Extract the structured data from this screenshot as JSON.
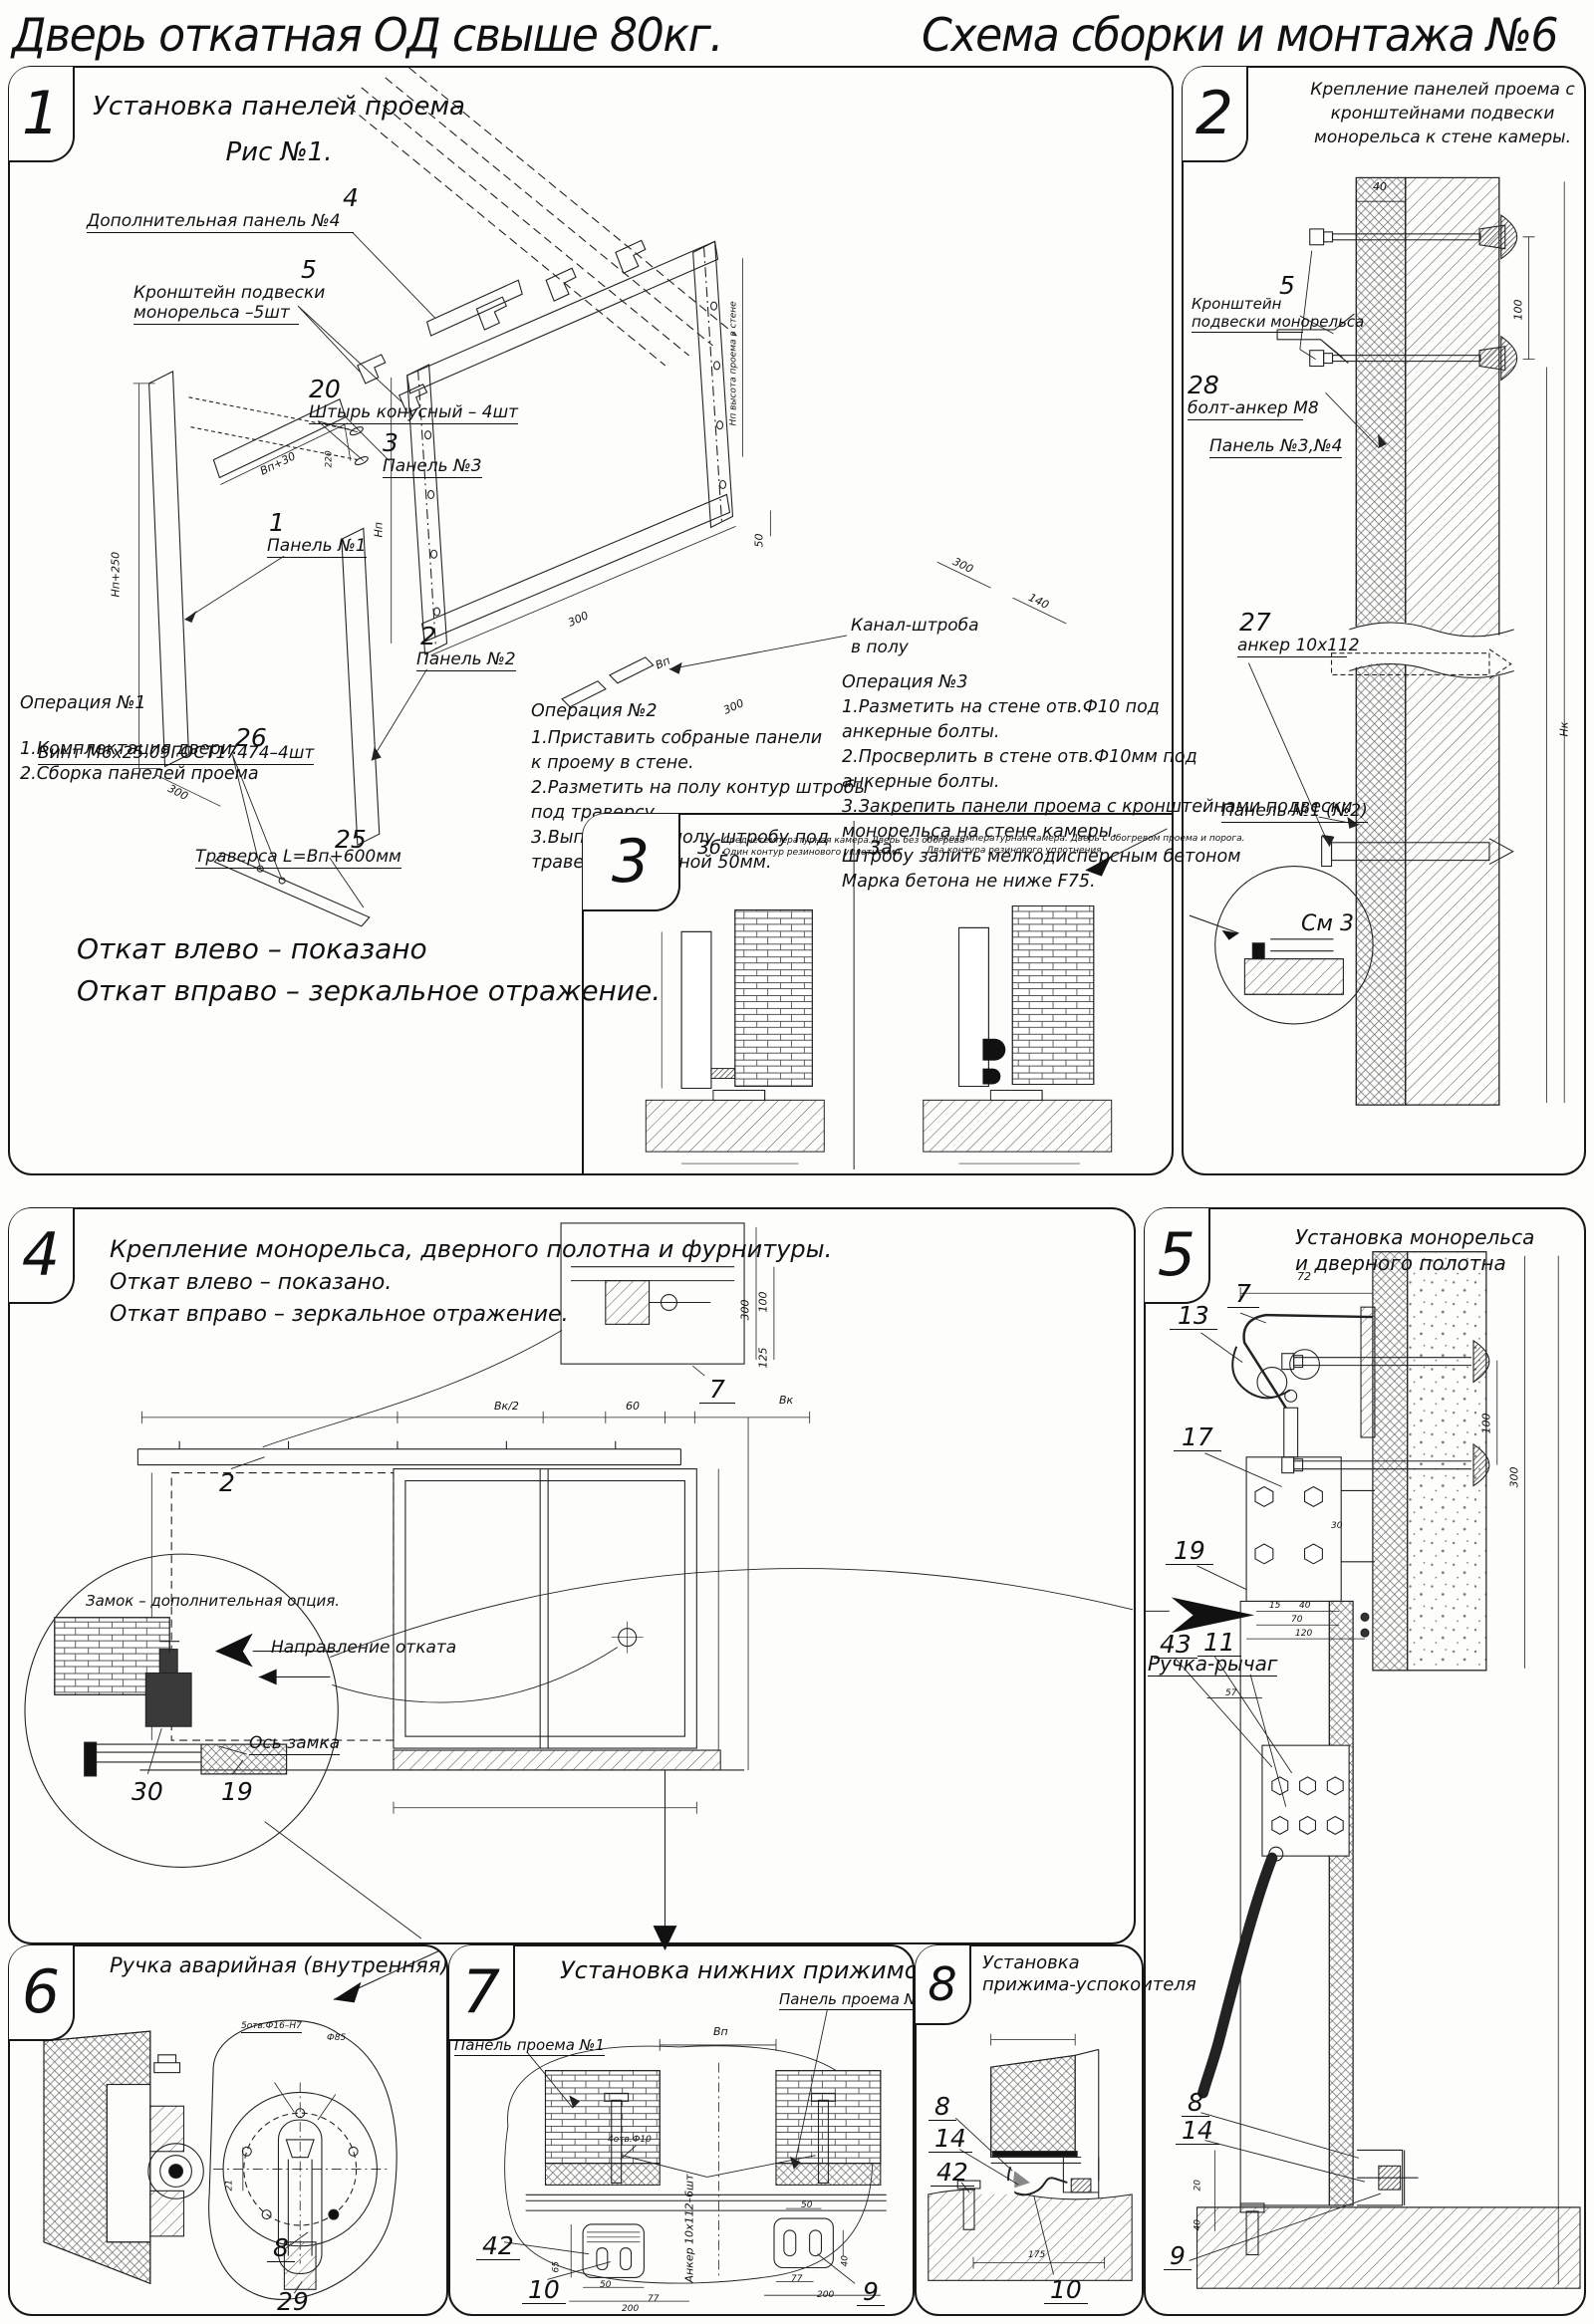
{
  "doc": {
    "title_left": "Дверь откатная ОД свыше 80кг.",
    "title_right": "Схема сборки и монтажа №6"
  },
  "p1": {
    "num": "1",
    "title": "Установка панелей проема",
    "subtitle": "Рис №1.",
    "c4_num": "4",
    "c4": "Дополнительная панель №4",
    "c5_num": "5",
    "c5_l1": "Кронштейн подвески",
    "c5_l2": "монорельса –5шт",
    "c20_num": "20",
    "c20": "Штырь конусный – 4шт",
    "c3_num": "3",
    "c3": "Панель №3",
    "c1_num": "1",
    "c1": "Панель №1",
    "c2_num": "2",
    "c2": "Панель №2",
    "c26_num": "26",
    "c26": "Винт М6х25.09ГОСТ17474–4шт",
    "c25_num": "25",
    "c25": "Траверса  L=Вп+600мм",
    "kanal_l1": "Канал-штроба",
    "kanal_l2": "в полу",
    "op1_t": "Операция №1",
    "op1_1": "1.Комплектация двери.",
    "op1_2": "2.Сборка панелей проема",
    "op2_t": "Операция №2",
    "op2_1": "1.Приставить собраные панели",
    "op2_2": "к проему в стене.",
    "op2_3": "2.Разметить на полу контур штробы",
    "op2_4": "под траверсу.",
    "op2_5": "3.Выполнить в полу штробу под",
    "op2_6": "траверсу, глубиной 50мм.",
    "op3_t": "Операция №3",
    "op3_1": "1.Разметить на стене отв.Ф10 под",
    "op3_2": "анкерные болты.",
    "op3_3": "2.Просверлить в стене отв.Ф10мм   под",
    "op3_4": "анкерные болты.",
    "op3_5": "3.Закрепить панели проема с кронштейнами подвески",
    "op3_6": "монорельса на стене камеры.",
    "op3_7": "Штробу залить мелкодисперсным бетоном",
    "op3_8": "Марка бетона не ниже   F75.",
    "note1": "Откат влево – показано",
    "note2": "Откат вправо – зеркальное отражение.",
    "d_np250": "Нп+250",
    "d_300a": "300",
    "d_vp30": "Вп+30",
    "d_220": "220",
    "d_np": "Нп",
    "d_wall": "Нп высота проема в стене",
    "d_300b": "300",
    "d_vp": "Вп",
    "d_300c": "300",
    "d_50": "50",
    "d_140": "140",
    "d_300d": "300"
  },
  "p2": {
    "num": "2",
    "t1": "Крепление панелей проема с",
    "t2": "кронштейнами  подвески",
    "t3": "монорельса к стене камеры.",
    "c5_num": "5",
    "c5_l1": "Кронштейн",
    "c5_l2": "подвески монорельса",
    "c28_num": "28",
    "c28": "болт-анкер М8",
    "pan34": "Панель №3,№4",
    "c27_num": "27",
    "c27": "анкер 10х112",
    "pan12": "Панель №1 (№2)",
    "sm3": "См 3",
    "d40": "40",
    "d100": "100",
    "dnk": "Нк"
  },
  "p3": {
    "num": "3",
    "fb_num": "3б.",
    "fb_l1": "Среднетемпературная камера.Дверь без обогрева",
    "fb_l2": "Один контур резинового уплотнения",
    "fa_num": "3а.",
    "fa_l1": "Низкотемпературная камера. Дверь с обогревом проема и порога.",
    "fa_l2": "Два контура резинового уплотнения"
  },
  "p4": {
    "num": "4",
    "t1": "Крепление монорельса, дверного полотна и фурнитуры.",
    "t2": "Откат влево – показано.",
    "t3": "Откат вправо – зеркальное отражение.",
    "c7": "7",
    "c2": "2",
    "lock": "Замок – дополнительная опция.",
    "dir": "Направление отката",
    "axis": "Ось замка",
    "c30": "30",
    "c19": "19",
    "d_vk2": "Вк/2",
    "d_60": "60",
    "d_vk": "Вк",
    "d_300": "300",
    "d_100": "100",
    "d_125": "125"
  },
  "p5": {
    "num": "5",
    "t1": "Установка монорельса",
    "t2": "и дверного полотна",
    "c7": "7",
    "c13": "13",
    "c17": "17",
    "c19": "19",
    "c43": "43",
    "c11": "11",
    "handle": "Ручка-рычаг",
    "c8": "8",
    "c14": "14",
    "c9": "9",
    "d72": "72",
    "d100": "100",
    "d300": "300",
    "d120": "120",
    "d57": "57",
    "d70": "70",
    "d40": "40",
    "d15": "15",
    "d30": "30",
    "d20": "20",
    "d40b": "40"
  },
  "p6": {
    "num": "6",
    "t": "Ручка аварийная (внутренняя)",
    "c8": "8",
    "c29": "29",
    "holes": "5отв.Ф16–Н7",
    "dia": "Ф85",
    "d21": "21"
  },
  "p7": {
    "num": "7",
    "t": "Установка нижних прижимов",
    "pan2": "Панель проема №2",
    "pan1": "Панель проема №1",
    "anchor": "Анкер 10х112–6шт",
    "c42": "42",
    "c10": "10",
    "c9": "9",
    "d_vp": "Вп",
    "d200a": "200",
    "d200b": "200",
    "d77a": "77",
    "d77b": "77",
    "d50a": "50",
    "d50b": "50",
    "d65": "65",
    "d40": "40",
    "holes": "4отв.Ф10"
  },
  "p8": {
    "num": "8",
    "t1": "Установка",
    "t2": "прижима-успокоителя",
    "c8": "8",
    "c14": "14",
    "c42": "42",
    "c10": "10",
    "d175": "175"
  }
}
